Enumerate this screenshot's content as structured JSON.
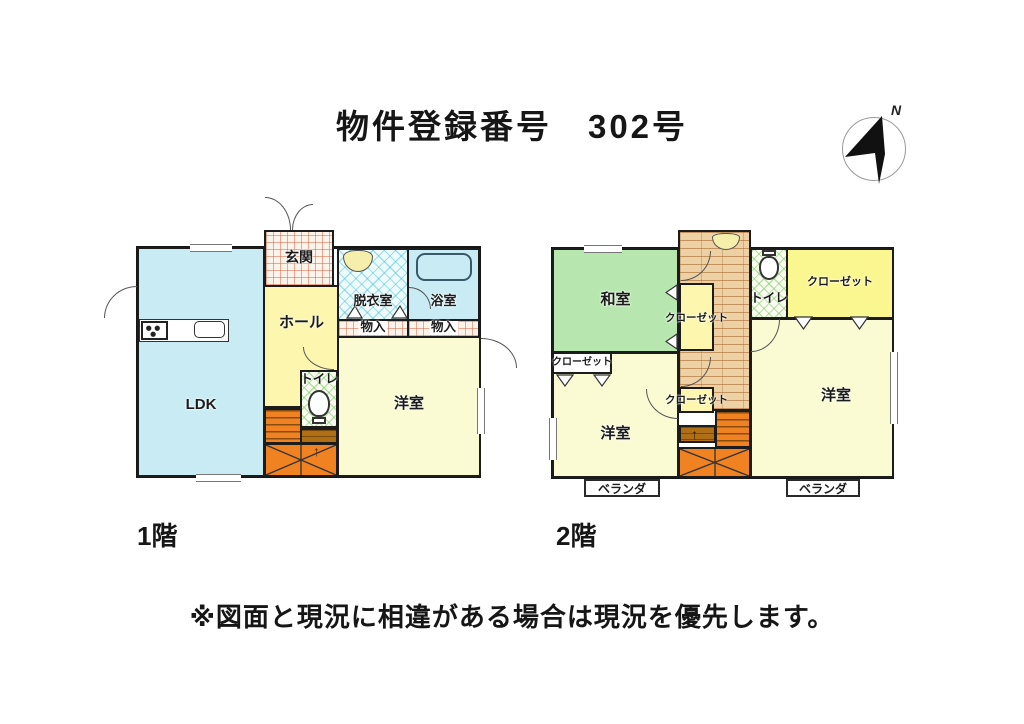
{
  "title": "物件登録番号　302号",
  "compass": {
    "north_label": "N"
  },
  "floor1": {
    "caption": "1階",
    "rooms": {
      "entrance": "玄関",
      "hall": "ホール",
      "ldk": "LDK",
      "dressing_room": "脱衣室",
      "bathroom": "浴室",
      "storage_left": "物入",
      "storage_right": "物入",
      "toilet": "トイレ",
      "western_room": "洋室"
    }
  },
  "floor2": {
    "caption": "2階",
    "rooms": {
      "japanese_room": "和室",
      "toilet": "トイレ",
      "closet_top_right": "クローゼット",
      "closet_center": "クローゼット",
      "closet_lower": "クローゼット",
      "closet_left": "クローゼット",
      "western_room_left": "洋室",
      "western_room_right": "洋室",
      "veranda_left": "ベランダ",
      "veranda_right": "ベランダ"
    }
  },
  "notes": {
    "disclaimer": "※図面と現況に相違がある場合は現況を優先します。"
  },
  "colors": {
    "ldk_cyan": "#c9ecf4",
    "hall_yellow": "#fcf6ae",
    "room_pale_yellow": "#fafbd2",
    "closet_yellow": "#fbf790",
    "tatami_green": "#b7e7af",
    "stairs_orange": "#f08222",
    "stairs_brown": "#b06f14",
    "corridor_wood": "#edd0a4",
    "wall": "#1c1c1c"
  }
}
